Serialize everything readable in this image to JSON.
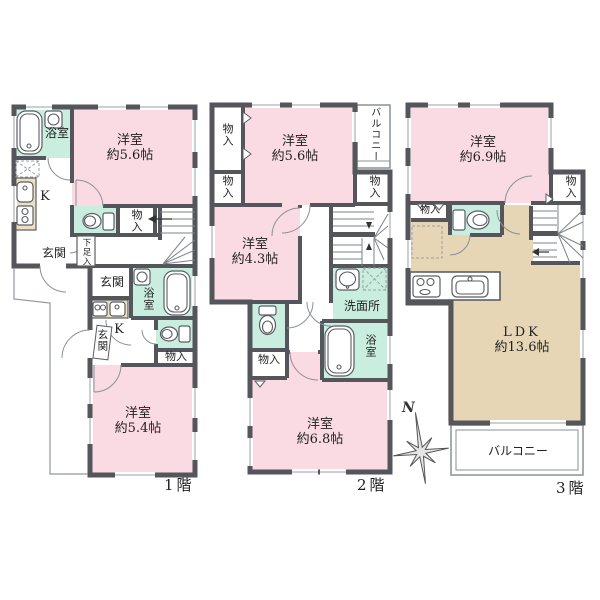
{
  "colors": {
    "bedroom_pink": "#FADBE3",
    "wet_area_mint": "#C9EEE0",
    "ldk_beige": "#E6D6B6",
    "counter_beige": "#ECDFC3",
    "wall_gray": "#54565C"
  },
  "compass": {
    "north": "N"
  },
  "floor1": {
    "caption": "1階",
    "labels": {
      "bath": "浴室",
      "room1_name": "洋室",
      "room1_size": "約5.6帖",
      "kitchen1": "K",
      "closet1": "物入",
      "entrance1": "玄関",
      "shoe_closet": "下足入",
      "entrance2": "玄関",
      "bath2": "浴室",
      "kitchen2": "K",
      "entrance2_door": "玄関",
      "closet2": "物入",
      "room2_name": "洋室",
      "room2_size": "約5.4帖"
    }
  },
  "floor2": {
    "caption": "2階",
    "labels": {
      "closet_top_left": "物入",
      "room1_name": "洋室",
      "room1_size": "約5.6帖",
      "balcony": "バルコニー",
      "closet_mid_left": "物入",
      "closet_right": "物入",
      "room2_name": "洋室",
      "room2_size": "約4.3帖",
      "washroom": "洗面所",
      "bath": "浴室",
      "closet_inner": "物入",
      "room3_name": "洋室",
      "room3_size": "約6.8帖"
    }
  },
  "floor3": {
    "caption": "3階",
    "labels": {
      "room1_name": "洋室",
      "room1_size": "約6.9帖",
      "closet_right": "物入",
      "closet_left": "物入",
      "ldk_name": "LDK",
      "ldk_size": "約13.6帖",
      "balcony": "バルコニー"
    }
  }
}
